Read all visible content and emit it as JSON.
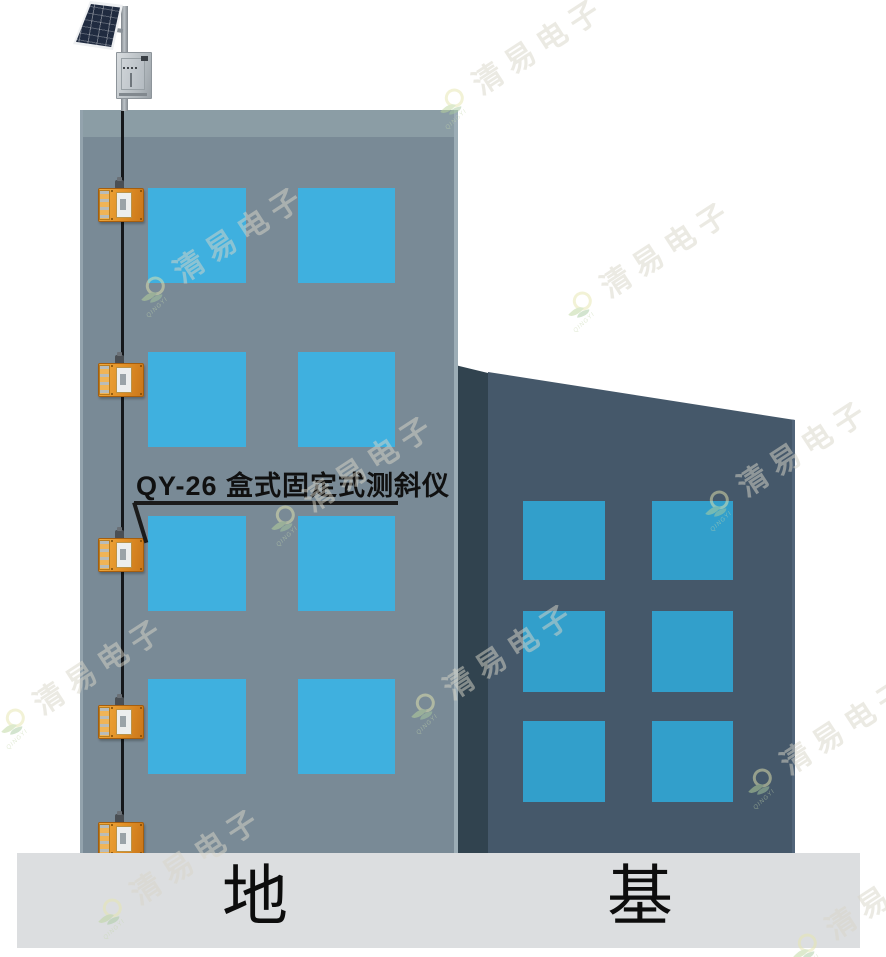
{
  "callout": {
    "text": "QY-26 盒式固定式测斜仪"
  },
  "ground": {
    "left_text": "地",
    "right_text": "基"
  },
  "watermark": {
    "text": "清易电子",
    "brand_small": "QINGYI"
  },
  "equipment": {
    "sensor_name": "box-type fixed inclinometer",
    "sensor_count": 5,
    "solar_panel": "solar-panel",
    "control_box": "stainless control box"
  },
  "buildings": {
    "main": {
      "window_rows": 4,
      "window_cols": 2
    },
    "rear": {
      "window_rows": 3,
      "window_cols": 2
    }
  },
  "colors": {
    "main_wall": "#798a96",
    "main_roof_band": "#8b9da5",
    "main_window": "#3fb0df",
    "rear_wall": "#45586a",
    "rear_wall_side": "#31434f",
    "rear_window": "#329fcb",
    "ground": "#dcdee0",
    "sensor_orange": "#e8962e",
    "cable": "#15181b"
  }
}
